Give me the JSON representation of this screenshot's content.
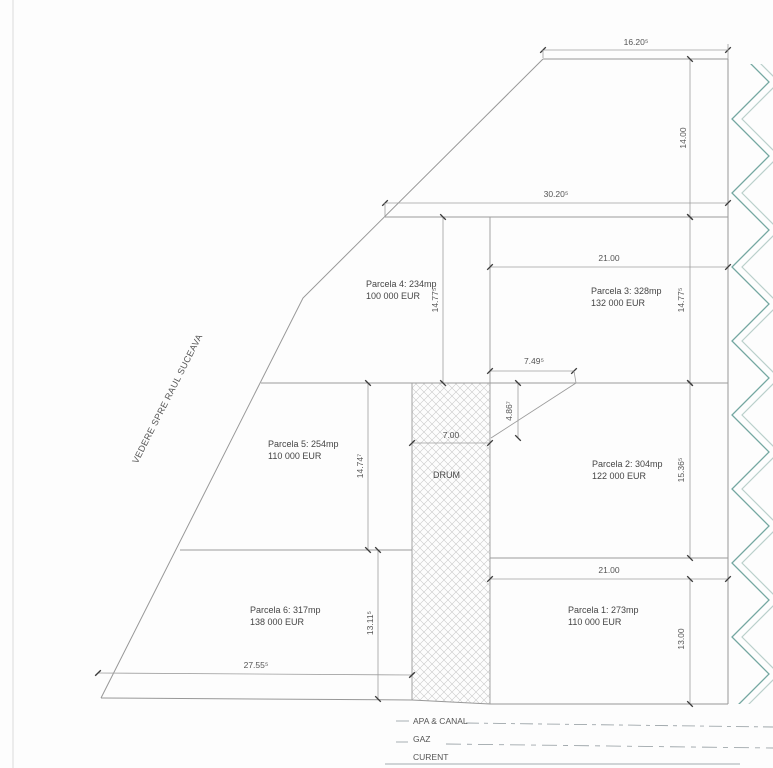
{
  "plan": {
    "view_direction_label": "VEDERE SPRE RAUL SUCEAVA",
    "road_label": "DRUM"
  },
  "parcels": {
    "p1": {
      "name": "Parcela 1: 273mp",
      "price": "110 000 EUR"
    },
    "p2": {
      "name": "Parcela 2: 304mp",
      "price": "122 000 EUR"
    },
    "p3": {
      "name": "Parcela 3: 328mp",
      "price": "132 000 EUR"
    },
    "p4": {
      "name": "Parcela 4: 234mp",
      "price": "100 000 EUR"
    },
    "p5": {
      "name": "Parcela 5: 254mp",
      "price": "110 000 EUR"
    },
    "p6": {
      "name": "Parcela 6: 317mp",
      "price": "138 000 EUR"
    }
  },
  "dims": {
    "top_width": "16.20⁵",
    "top_height": "14.00",
    "strip_width": "30.20⁵",
    "p3_width": "21.00",
    "p4_height": "14.77⁵",
    "p3_height": "14.77⁵",
    "access_width": "7.49⁵",
    "access_height": "4.86⁷",
    "road_width": "7.00",
    "p5_height": "14.74⁷",
    "p2_height": "15.36⁵",
    "p1_width": "21.00",
    "p1_height": "13.00",
    "p6_height": "13.11⁵",
    "p6_width": "27.55⁵"
  },
  "utilities": {
    "apa": "APA & CANAL",
    "gaz": "GAZ",
    "curent": "CURENT"
  },
  "colors": {
    "boundary": "#989898",
    "dimension": "#9e9e9e",
    "tick": "#3a3a3a",
    "hatch_teal": "#74a7a1",
    "hatch_echo": "#bad0cb",
    "road_hatch": "#c9c9c9",
    "utility_line": "#9fa7ab"
  }
}
